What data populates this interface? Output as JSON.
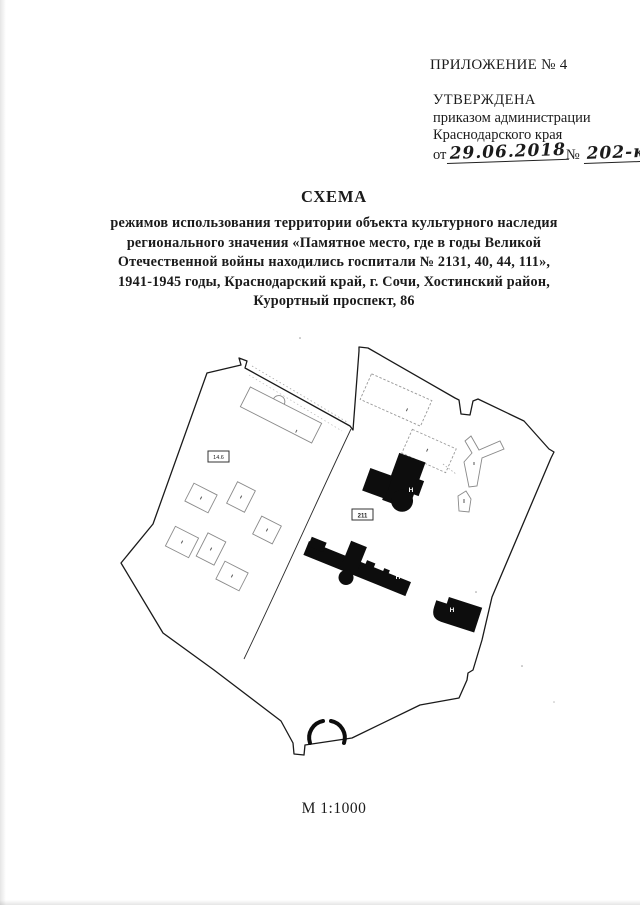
{
  "header": {
    "appendix": "ПРИЛОЖЕНИЕ № 4",
    "approved": "УТВЕРЖДЕНА",
    "approved_by_line1": "приказом администрации",
    "approved_by_line2": "Краснодарского края",
    "date_prefix": "от",
    "date_handwritten": "29.06.2018",
    "number_prefix": "№",
    "number_handwritten": "202-кн"
  },
  "title": {
    "heading": "СХЕМА",
    "lines": [
      "режимов использования территории объекта культурного наследия",
      "регионального значения «Памятное место, где в годы Великой",
      "Отечественной войны находились госпитали № 2131, 40, 44, 111»,",
      "1941-1945 годы, Краснодарский край, г. Сочи, Хостинский район,",
      "Курортный проспект, 86"
    ]
  },
  "map": {
    "scale": "М 1:1000",
    "labels": {
      "left_box": "14.6",
      "center_box": "211",
      "building_top": "Н",
      "building_middle": "Н",
      "building_bottom": "Н"
    },
    "colors": {
      "boundary": "#1a1a1a",
      "building_fill": "#0d0d0d",
      "outline_building": "#8a8a8a"
    }
  }
}
